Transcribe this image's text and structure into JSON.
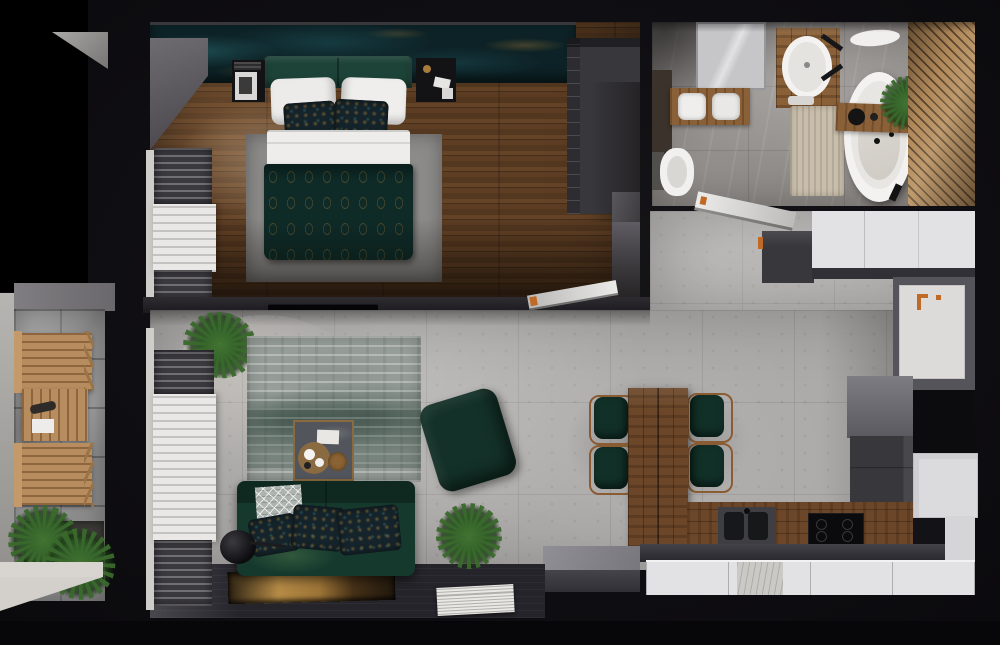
{
  "scene": {
    "type": "apartment-3d-floor-plan-render",
    "view": "top-down",
    "rooms": [
      {
        "name": "bedroom",
        "items": [
          "accent-wall",
          "double-bed",
          "headboard",
          "white-pillows",
          "patterned-pillows",
          "patterned-duvet",
          "area-rug",
          "nightstand-left",
          "nightstand-right",
          "wardrobe",
          "blackout-curtains",
          "sheer-curtain",
          "interior-door"
        ]
      },
      {
        "name": "bathroom",
        "items": [
          "shower",
          "side-cabinet",
          "towel-shelf",
          "toilet",
          "wood-vanity",
          "oval-sink",
          "black-faucet",
          "bath-mat",
          "freestanding-bathtub",
          "tub-tray",
          "plant",
          "wood-slat-wall"
        ]
      },
      {
        "name": "hallway",
        "items": [
          "open-door",
          "dark-cabinet",
          "white-wardrobe",
          "entry-door"
        ]
      },
      {
        "name": "living-room",
        "items": [
          "tv",
          "corner-plant",
          "blackout-curtains",
          "sheer-curtain",
          "distressed-rug",
          "coffee-table",
          "serving-tray",
          "green-sofa",
          "throw-blanket",
          "cushions",
          "floor-lamp",
          "green-ottoman",
          "floor-plant",
          "gold-artwork",
          "white-print"
        ]
      },
      {
        "name": "kitchen",
        "items": [
          "dining-table-island",
          "dining-chair",
          "dining-chair",
          "dining-chair",
          "dining-chair",
          "wood-counter",
          "double-sink",
          "cooktop",
          "white-base-cabinets",
          "marble-dishwasher-panel",
          "tall-dark-cabinets",
          "white-window",
          "entry-wall"
        ]
      },
      {
        "name": "balcony",
        "items": [
          "folding-chair",
          "slat-table",
          "folding-chair",
          "grass-planter",
          "white-parapet"
        ]
      }
    ]
  },
  "palette": {
    "backdrop": "#0f0e12",
    "wall_black": "#000000",
    "wood_floor": "#5d3e24",
    "accent_wall": "#0d2226",
    "rug_bedroom": "#8c8b89",
    "headboard": "#1d4338",
    "duvet": "#0e2b28",
    "pillow_dark": "#15242b",
    "wardrobe": "#38373c",
    "curtain_blackout": "#3a393e",
    "curtain_sheer": "#e9e8e6",
    "tile_bath": "#94908d",
    "vanity_wood": "#8a6038",
    "tub": "#f3f2f0",
    "mat": "#c9beac",
    "slat_wood": "#b1895a",
    "concrete": "#a9a7a5",
    "rug_living": "#99a09b",
    "sofa": "#16392e",
    "ottoman": "#133128",
    "coffee_table": "#52555c",
    "dark_floor_strip": "#25242a",
    "counter_wood": "#6b4628",
    "chair_seat": "#113027",
    "chair_wood": "#8a5c33",
    "sink_unit": "#3f3e43",
    "counter_front": "#34333a",
    "cabinet_white": "#e2e2e4",
    "cabinet_dark": "#38373c",
    "wall_gray": "#6f6e74",
    "door_white": "#dcdbd9",
    "handle_orange": "#c06a25",
    "balcony_tile": "#8c8c8c",
    "balcony_wood": "#b78c5f",
    "planter": "#3b3a36",
    "white_ledge": "#d8d5d0",
    "throw_gray": "#adb3af"
  }
}
